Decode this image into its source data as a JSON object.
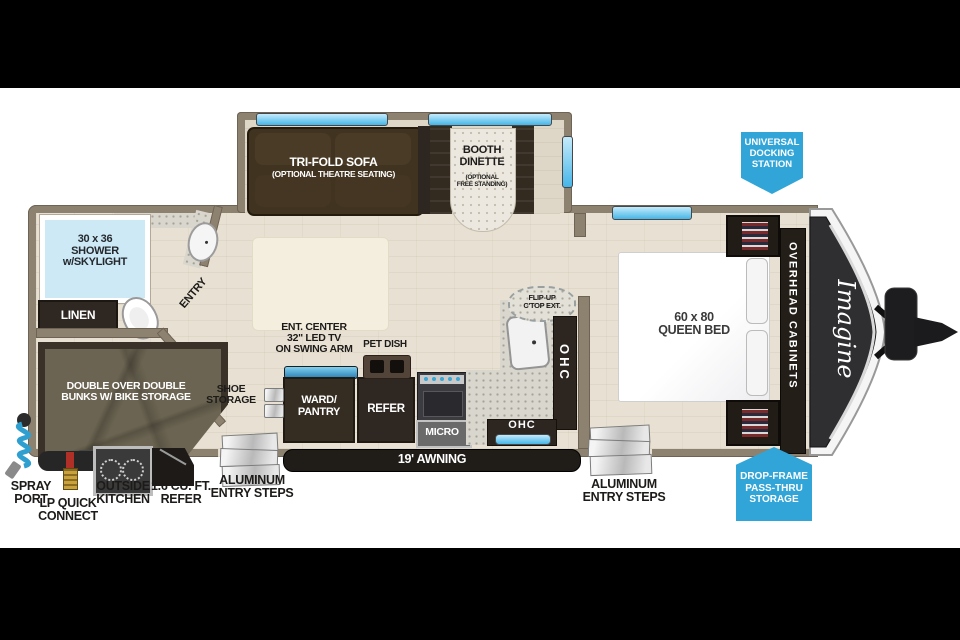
{
  "fp": {
    "badge_docking": "UNIVERSAL\nDOCKING\nSTATION",
    "badge_dropframe": "DROP-FRAME\nPASS-THRU\nSTORAGE",
    "sofa_title": "TRI-FOLD SOFA",
    "sofa_sub": "(OPTIONAL THEATRE SEATING)",
    "dinette_title": "BOOTH\nDINETTE",
    "dinette_sub": "(OPTIONAL\nFREE STANDING)",
    "shower": "30 x 36\nSHOWER\nw/SKYLIGHT",
    "linen": "LINEN",
    "entry": "ENTRY",
    "bunks": "DOUBLE OVER DOUBLE\nBUNKS W/ BIKE STORAGE",
    "ent_center": "ENT. CENTER\n32\" LED TV\nON SWING ARM",
    "pet_dish": "PET DISH",
    "ward": "WARD/\nPANTRY",
    "refer": "REFER",
    "micro": "MICRO",
    "ohc_vertical": "OHC",
    "ohc_horizontal": "OHC",
    "fliptop": "FLIP-UP\nC'TOP EXT.",
    "queen_bed": "60 x 80\nQUEEN BED",
    "overhead": "OVERHEAD CABINETS",
    "brand": "Imagine",
    "shoe": "SHOE\nSTORAGE",
    "awning": "19' AWNING",
    "spray": "SPRAY\nPORT",
    "lp": "LP QUICK\nCONNECT",
    "outside_kitchen": "OUTSIDE\nKITCHEN",
    "mini_refer": "1.6 CU. FT.\nREFER",
    "steps_left": "ALUMINUM\nENTRY STEPS",
    "steps_right": "ALUMINUM\nENTRY STEPS"
  },
  "colors": {
    "badge_blue": "#32a5d8",
    "wall_taupe": "#8d8170",
    "floor_beige": "#e8e1d3",
    "dark_cabinet": "#352c22",
    "window_blue": "#45b6e8",
    "bunk_olive": "#6b6452",
    "counter_speckle": "#d9d6ce",
    "bed_white": "#fbfbfb"
  }
}
